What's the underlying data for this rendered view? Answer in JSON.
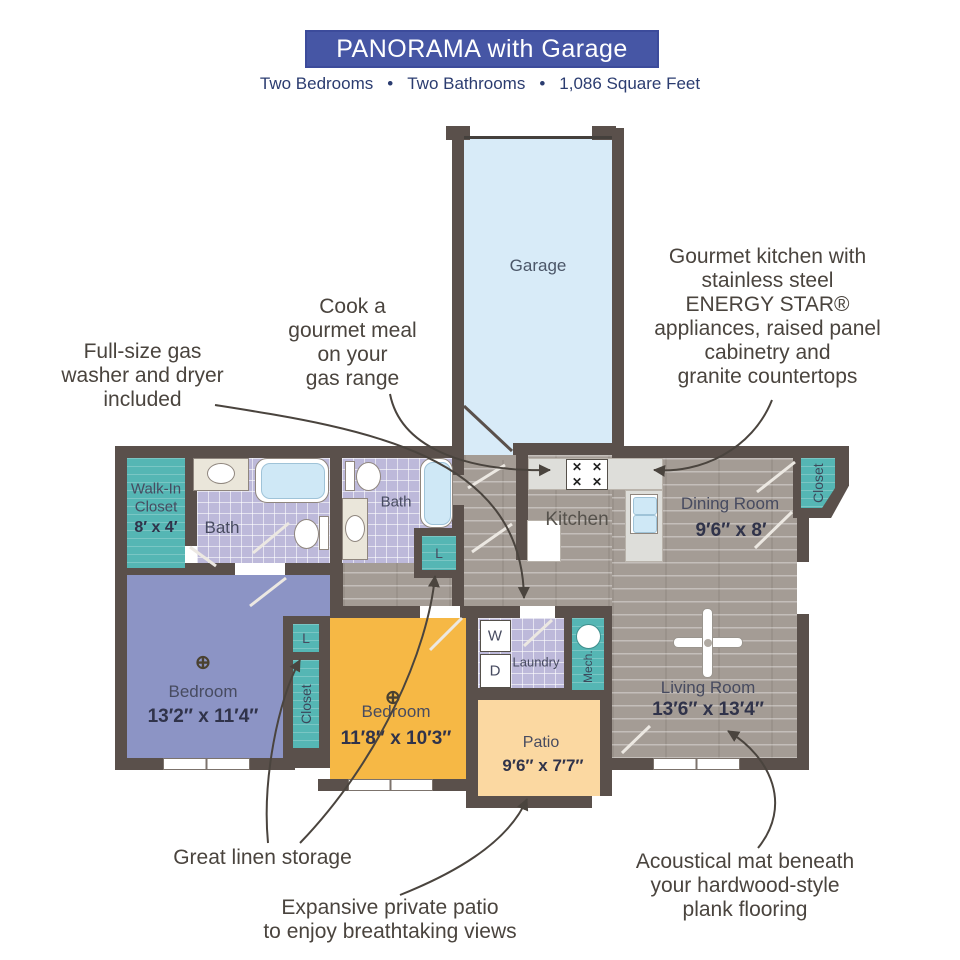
{
  "header": {
    "title": "PANORAMA with Garage",
    "subtitle_items": [
      "Two Bedrooms",
      "Two Bathrooms",
      "1,086 Square Feet"
    ],
    "bullet": "•"
  },
  "plan": {
    "garage": {
      "name": "Garage"
    },
    "walk_in_closet": {
      "line1": "Walk-In",
      "line2": "Closet",
      "dims": "8′ x 4′"
    },
    "bath_master": {
      "name": "Bath"
    },
    "bath_second": {
      "name": "Bath"
    },
    "kitchen": {
      "name": "Kitchen"
    },
    "dining": {
      "name": "Dining Room",
      "dims": "9′6″ x 8′"
    },
    "dining_closet": {
      "name": "Closet"
    },
    "bedroom_master": {
      "name": "Bedroom",
      "dims": "13′2″ x 11′4″"
    },
    "bedroom_second": {
      "name": "Bedroom",
      "dims": "11′8″ x 10′3″"
    },
    "hall_closet": {
      "name": "Closet"
    },
    "linen_hall": {
      "name": "L"
    },
    "linen_bath": {
      "name": "L"
    },
    "laundry": {
      "name": "Laundry",
      "washer": "W",
      "dryer": "D"
    },
    "mech": {
      "name": "Mech."
    },
    "patio": {
      "name": "Patio",
      "dims": "9′6″ x 7′7″"
    },
    "living": {
      "name": "Living Room",
      "dims": "13′6″ x 13′4″"
    }
  },
  "annotations": {
    "cook": "Cook a\ngourmet meal\non your\ngas range",
    "gourmet": "Gourmet kitchen with\nstainless steel\nENERGY STAR®\nappliances, raised panel\ncabinetry and\ngranite countertops",
    "washer": "Full-size gas\nwasher and dryer\nincluded",
    "linen": "Great linen storage",
    "patio": "Expansive private patio\nto enjoy breathtaking views",
    "acoustic": "Acoustical mat beneath\nyour hardwood-style\nplank flooring"
  },
  "icons": {
    "ceiling_fan": "⊕",
    "burner": "✕"
  },
  "colors": {
    "banner": "#4656a5",
    "wall": "#5a504b",
    "teal": "#55b6b4",
    "bedroom_master": "#8c94c5",
    "bedroom_second": "#f6b845",
    "patio": "#fbd8a1",
    "garage": "#d8ebf8",
    "tile": "#bdb9da",
    "wood": "#a49c95",
    "annotation_text": "#4a443e"
  }
}
